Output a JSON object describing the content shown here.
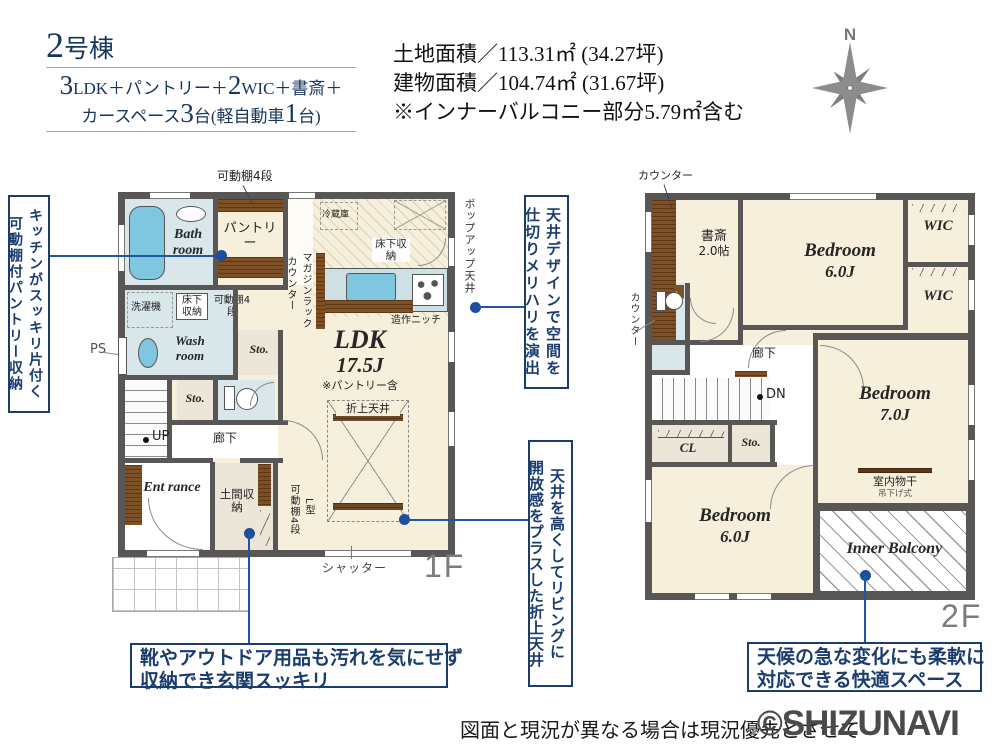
{
  "header": {
    "building_no": "2号棟",
    "layout": {
      "n1": "3",
      "t1": "LDK＋パントリー＋",
      "n2": "2",
      "t2": "WIC＋書斎＋",
      "t3": "カースペース",
      "n3": "3",
      "t4": "台(軽自動車",
      "n4": "1",
      "t5": "台)"
    },
    "land_area": "土地面積／113.31㎡ (34.27坪)",
    "building_area": "建物面積／104.74㎡ (31.67坪)",
    "balcony_note": "※インナーバルコニー部分5.79㎡含む"
  },
  "compass": {
    "north": "N"
  },
  "floor1": {
    "floor_label": "1F",
    "bath_room": "Bath room",
    "pantry": "パントリー",
    "shelf_4dan": "可動棚4段",
    "counter": "カウンター",
    "magazine_rack": "マガジンラック",
    "fridge": "冷蔵庫",
    "underfloor_storage": "床下収納",
    "popup_ceiling": "ポップアップ天井",
    "craft_niche": "造作ニッチ",
    "washer": "洗濯機",
    "wash_room": "Wash room",
    "ps": "PS",
    "storage": "Sto.",
    "up": "UP",
    "corridor": "廊下",
    "entrance": "Ent rance",
    "doma_storage": "土間収納",
    "l_type": "L型",
    "ldk": "LDK",
    "ldk_size": "17.5J",
    "ldk_note": "※パントリー含",
    "folded_ceiling": "折上天井",
    "shutter": "シャッター"
  },
  "floor2": {
    "floor_label": "2F",
    "counter": "カウンター",
    "study": "書斎",
    "study_size": "2.0帖",
    "bedroom": "Bedroom",
    "bedroom1_size": "6.0J",
    "bedroom2_size": "7.0J",
    "bedroom3_size": "6.0J",
    "wic": "WIC",
    "corridor": "廊下",
    "dn": "DN",
    "closet": "CL",
    "storage": "Sto.",
    "indoor_drying": "室内物干",
    "drying_type": "吊下げ式",
    "inner_balcony": "Inner Balcony"
  },
  "annotations": {
    "pantry_line1": "キッチンがスッキリ片付く",
    "pantry_line2": "可動棚付パントリー収納",
    "ceiling_line1": "天井デザインで空間を",
    "ceiling_line2": "仕切りメリハリを演出",
    "folded_line1": "天井を高くしてリビングに",
    "folded_line2": "開放感をプラスした折上天井",
    "entrance_line1": "靴やアウトドア用品も汚れを気にせず",
    "entrance_line2": "収納でき玄関スッキリ",
    "balcony_line1": "天候の急な変化にも柔軟に",
    "balcony_line2": "対応できる快適スペース"
  },
  "footer": {
    "disclaimer": "図面と現況が異なる場合は現況優先とさせて",
    "watermark": "©SHIZUNAVI"
  },
  "colors": {
    "navy": "#1b3d6e",
    "leader_blue": "#2156a5",
    "wall_gray": "#595656",
    "floor_cream": "#f5efdc",
    "floor_blue": "#d9e7ea",
    "floor_beige": "#ece6d8",
    "wood_brown": "#7d5026",
    "fixture_blue": "#7fc6df"
  }
}
